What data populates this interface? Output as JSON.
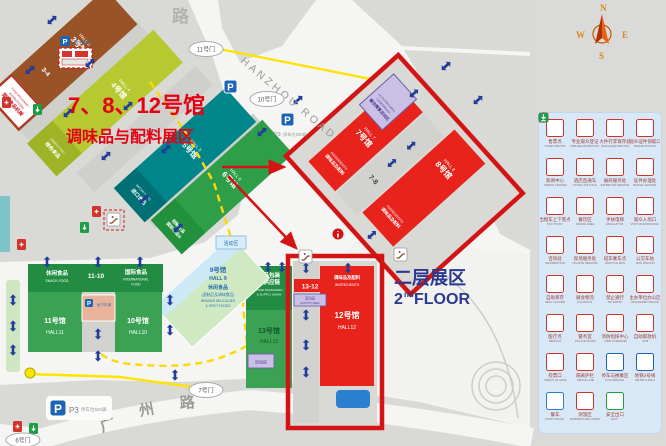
{
  "title": {
    "line1": "7、8、12号馆",
    "line2": "调味品与配料展区"
  },
  "floor": {
    "cn": "二层展区",
    "num": "2",
    "sup": "nd",
    "word": "FLOOR"
  },
  "compass": {
    "n": "N",
    "e": "E",
    "s": "S",
    "w": "W"
  },
  "roads": {
    "top_partial": "路",
    "hanzhou": "HANZHOU ROAD",
    "gz1": "广",
    "gz2": "州",
    "gz3": "路"
  },
  "gates": {
    "g11": "11号门",
    "g10": "10号门",
    "g7": "7号门",
    "g6": "6号门"
  },
  "parking": {
    "p": "P",
    "underground": "地下车库",
    "p3": "P3",
    "lot_left": "停车位550辆",
    "lot_right": "停车位280辆"
  },
  "areas": {
    "activity": "活动区"
  },
  "colors": {
    "highlight_red": "#d41414",
    "hall_red": "#e8231c",
    "hall_green": "#3ba254",
    "hall_teal": "#00858a",
    "hall_brown": "#9a5327",
    "hall_lime": "#b7c931",
    "accent_blue": "#2b3990",
    "legend_bg": "#d9e8f7"
  },
  "halls": {
    "h3": {
      "cn": "3号馆",
      "en": "HALL 3",
      "band_cn": "国际食品机械",
      "band_en1": "INTERNATIONAL",
      "band_en2": "FOOD MACHINERY",
      "link": "3-4"
    },
    "h4": {
      "cn": "4号馆",
      "en": "HALL 4",
      "tag_cn": "绿色食品",
      "tag_en": "GREEN FOOD"
    },
    "h5": {
      "cn": "5号馆",
      "en": "HALL 5",
      "tag_cn": "进口食品",
      "tag_en": "IMPORT FOOD"
    },
    "h6": {
      "cn": "6号馆",
      "en": "HALL 6",
      "tag_cn1": "国际食品&",
      "tag_cn2": "创新食品"
    },
    "h7": {
      "cn": "7号馆",
      "en": "HALL 7",
      "tag_cn": "调味品及配料",
      "tag_en": "INGREDIENTS",
      "link": "7-8",
      "act_cn": "餐饮赛事活动区",
      "act_en1": "CONFERENCE",
      "act_en2": "ACTIVITIES AREA"
    },
    "h8": {
      "cn": "8号馆",
      "en": "HALL 8",
      "tag_cn": "调味品及配料",
      "tag_en": "INGREDIENTS"
    },
    "h9": {
      "cn": "9号馆",
      "en": "HALL 9",
      "tag_cn1": "休闲食品",
      "tag_cn2": "(卤制品及调味食品)",
      "tag_en1": "BRAISED DELICACIES",
      "tag_en2": "& SPICY FOODS"
    },
    "h10": {
      "cn": "10号馆",
      "en": "HALL10",
      "tag_cn": "国际食品",
      "tag_en1": "INTERNATIONAL",
      "tag_en2": "FOOD"
    },
    "h11": {
      "cn": "11号馆",
      "en": "HALL11",
      "tag_cn": "休闲食品",
      "tag_en": "SNACK FOOD",
      "link": "11-10"
    },
    "h12": {
      "cn": "12号馆",
      "en": "HALL12",
      "tag_cn": "调味品及配料",
      "tag_en": "INGREDIENTS",
      "link": "13-12",
      "act_cn": "活动区",
      "act_en": "ACTIVITY AREA"
    },
    "h13": {
      "cn": "13号馆",
      "en": "HALL13",
      "tag_cn1": "食品包装",
      "tag_cn2": "及供应链",
      "tag_en1": "FOOD PACKAGING",
      "tag_en2": "& SUPPLY CHAIN",
      "act": "活动区"
    }
  },
  "legend": {
    "rows": [
      [
        {
          "g": "ticket",
          "cn": "售票点",
          "en": "TICKET BOOTH",
          "c": "#cf3227"
        },
        {
          "g": "register",
          "cn": "专业观众登记",
          "en": "PRE-REGISTRATION",
          "c": "#cf3227"
        },
        {
          "g": "baggage",
          "cn": "大件行李寄存处",
          "en": "BAGGAGE DEPOSIT",
          "c": "#cf3227"
        },
        {
          "g": "badge",
          "cn": "观众证件领取口",
          "en": "BADGE PICKUP",
          "c": "#cf3227"
        }
      ],
      [
        {
          "g": "press",
          "cn": "新闻中心",
          "en": "PRESS CENTER",
          "c": "#cf3227"
        },
        {
          "g": "hotel",
          "cn": "酒店直通车",
          "en": "HOTEL SHUTTLE",
          "c": "#cf3227"
        },
        {
          "g": "service-desk",
          "cn": "展商服务处",
          "en": "EXHIBITOR SERVICE",
          "c": "#cf3227"
        },
        {
          "g": "meeting",
          "cn": "证件办理处",
          "en": "BADGE CENTER",
          "c": "#cf3227"
        }
      ],
      [
        {
          "g": "taxi",
          "cn": "出租车上下客点",
          "en": "TAXI POINT",
          "c": "#cf3227"
        },
        {
          "g": "dining",
          "cn": "餐饮区",
          "en": "DINING AREA",
          "c": "#cf3227"
        },
        {
          "g": "escalator",
          "cn": "手扶电梯",
          "en": "ESCALATOR",
          "c": "#cf3227"
        },
        {
          "g": "entrance",
          "cn": "观众入场口",
          "en": "VISITOR ENTRANCE",
          "c": "#cf3227"
        }
      ],
      [
        {
          "g": "info",
          "cn": "咨询处",
          "en": "INFORMATION",
          "c": "#cf3227"
        },
        {
          "g": "crowd",
          "cn": "现场服务处",
          "en": "ON-SITE SERVICE",
          "c": "#cf3227"
        },
        {
          "g": "shuttle",
          "cn": "班车乘车点",
          "en": "SHUTTLE BUS",
          "c": "#cf3227"
        },
        {
          "g": "bus",
          "cn": "公交车站",
          "en": "BUS STATION",
          "c": "#cf3227"
        }
      ],
      [
        {
          "g": "locker",
          "cn": "自助寄存",
          "en": "SELF LOCKER",
          "c": "#cf3227"
        },
        {
          "g": "logistics",
          "cn": "展会物流",
          "en": "LOGISTICS",
          "c": "#cf3227"
        },
        {
          "g": "noentry",
          "cn": "禁止通行",
          "en": "NO ENTRY",
          "c": "#cf3227"
        },
        {
          "g": "office",
          "cn": "主办单位办公区",
          "en": "ORGANIZER OFFICE",
          "c": "#cf3227"
        }
      ],
      [
        {
          "g": "medical",
          "cn": "医疗点",
          "en": "MEDICAL",
          "c": "#cf3227"
        },
        {
          "g": "police",
          "cn": "警务室",
          "en": "POLICE ROOM",
          "c": "#cf3227"
        },
        {
          "g": "fire",
          "cn": "消防指挥中心",
          "en": "FIRE COMMAND",
          "c": "#cf3227"
        },
        {
          "g": "atm",
          "cn": "自助取款机",
          "en": "ATM",
          "c": "#cf3227"
        }
      ],
      [
        {
          "g": "gate-check",
          "cn": "检票口",
          "en": "CHECK-IN GATE",
          "c": "#cf3227"
        },
        {
          "g": "barrier",
          "cn": "隔离护栏",
          "en": "FENCE LINE",
          "c": "#cf3227"
        },
        {
          "g": "parking",
          "cn": "停车与换乘区",
          "en": "P+R PARKING",
          "c": "#1c64b5"
        },
        {
          "g": "metro",
          "cn": "地铁2号线",
          "en": "METRO LINE 2",
          "c": "#1c64b5"
        }
      ],
      [
        {
          "g": "foodtruck",
          "cn": "餐车",
          "en": "FOOD TRUCK",
          "c": "#2a7fd0"
        },
        {
          "g": "thermo",
          "cn": "测温区",
          "en": "TEMPERATURE CHECK",
          "c": "#cf3227"
        },
        {
          "g": "exit",
          "cn": "安全出口",
          "en": "EXIT",
          "c": "#1d9e46"
        }
      ]
    ]
  }
}
